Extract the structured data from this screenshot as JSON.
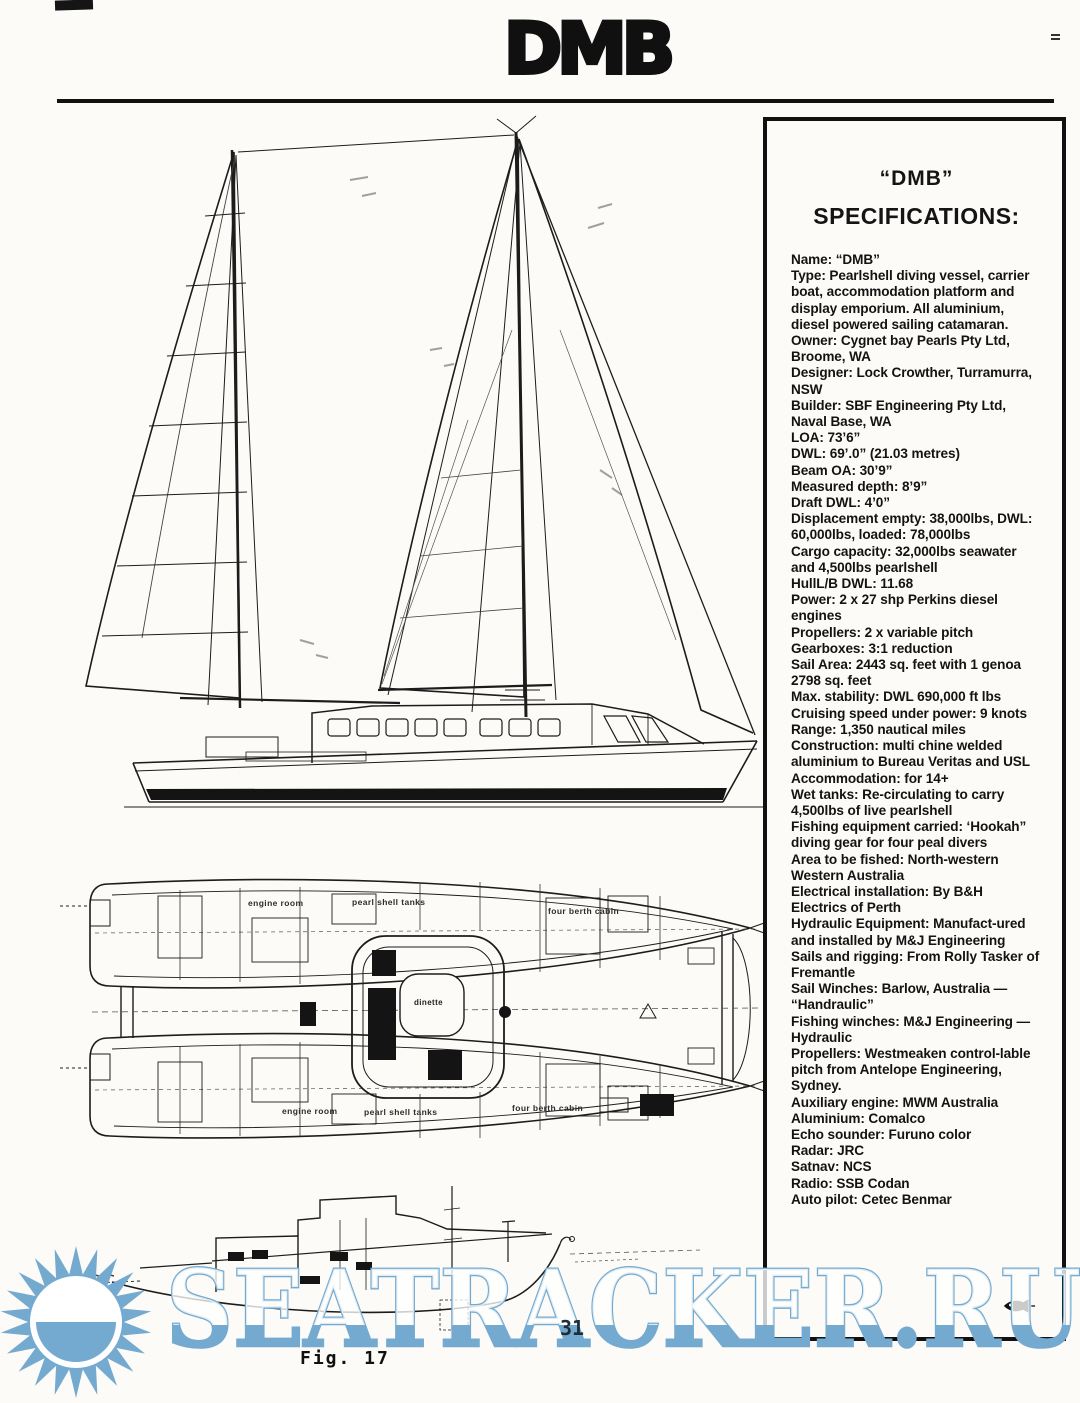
{
  "page": {
    "title": "DMB",
    "page_number": "31",
    "figure_caption": "Fig. 17"
  },
  "watermark": {
    "text": "SEATRACKER.RU",
    "color": "#74aacf"
  },
  "colors": {
    "ink": "#141414",
    "paper": "#fcfbf8",
    "watermark_blue": "#74aacf"
  },
  "spec_box": {
    "title_line1": "“DMB”",
    "title_line2": "SPECIFICATIONS:",
    "items": [
      "Name: “DMB”",
      "Type: Pearlshell diving vessel, carrier boat, accommodation platform and display emporium. All aluminium, diesel powered sailing catamaran.",
      "Owner: Cygnet bay Pearls Pty Ltd, Broome, WA",
      "Designer: Lock Crowther, Turramurra, NSW",
      "Builder: SBF Engineering Pty Ltd, Naval Base, WA",
      "LOA: 73’6”",
      "DWL: 69’.0” (21.03 metres)",
      "Beam OA: 30’9”",
      "Measured depth: 8’9”",
      "Draft DWL: 4’0”",
      "Displacement empty: 38,000lbs, DWL: 60,000lbs, loaded: 78,000lbs",
      "Cargo capacity: 32,000lbs seawater and 4,500lbs pearlshell",
      "HullL/B DWL: 11.68",
      "Power: 2 x 27 shp Perkins diesel engines",
      "Propellers: 2 x variable pitch",
      "Gearboxes: 3:1 reduction",
      "Sail Area: 2443 sq. feet with 1 genoa 2798 sq. feet",
      "Max. stability: DWL 690,000 ft lbs",
      "Cruising speed under power: 9 knots",
      "Range: 1,350 nautical miles",
      "Construction: multi chine welded aluminium to Bureau Veritas and USL",
      "Accommodation: for 14+",
      "Wet tanks: Re-circulating to carry 4,500lbs of live pearlshell",
      "Fishing equipment carried: ‘Hookah” diving gear for four peal divers",
      "Area to be fished: North-western Western Australia",
      "Electrical installation: By B&H Electrics of Perth",
      "Hydraulic Equipment: Manufact-ured and installed by M&J Engineering",
      "Sails and rigging: From Rolly Tasker of Fremantle",
      "Sail Winches: Barlow, Australia — “Handraulic”",
      "Fishing winches: M&J Engineering — Hydraulic",
      "Propellers: Westmeaken control-lable pitch from Antelope Engineering, Sydney.",
      "Auxiliary engine: MWM Australia",
      "Aluminium: Comalco",
      "Echo sounder: Furuno color",
      "Radar: JRC",
      "Satnav: NCS",
      "Radio: SSB Codan",
      "Auto pilot: Cetec Benmar"
    ]
  },
  "plan_labels": {
    "engine_room": "engine room",
    "pearl_shell_tanks": "pearl shell tanks",
    "four_berth_cabin": "four berth cabin",
    "dinette": "dinette"
  }
}
